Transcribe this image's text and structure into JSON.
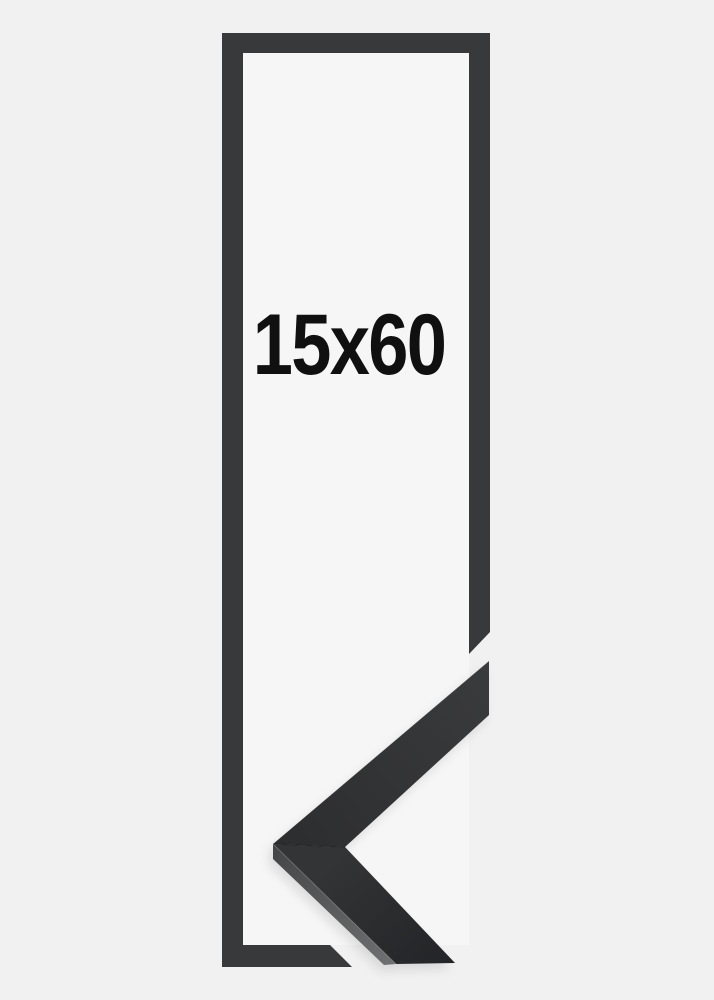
{
  "product": {
    "size_label": "15x60"
  },
  "image": {
    "frame_outline": "black rectangular frame outline, tall narrow portrait orientation, right and bottom borders cut diagonally near lower right",
    "corner_sample": "photographed black frame moulding mitered corner, chevron pointing left, overlapping the lower right of the outline",
    "corner_sample_finish": "matte dark gray-black wood moulding with lighter angled side edge"
  },
  "colors": {
    "background": "#f1f1f2",
    "opening_background": "#f6f6f7",
    "outline": "#38393b",
    "label_text": "#101010",
    "moulding_dark": "#2c2d2f",
    "moulding_dark_light": "#3a3b3d",
    "moulding_face_top": "#333436",
    "moulding_face_bottom": "#232427",
    "moulding_side_dark": "#454648",
    "moulding_side_light": "#6e6f71"
  }
}
